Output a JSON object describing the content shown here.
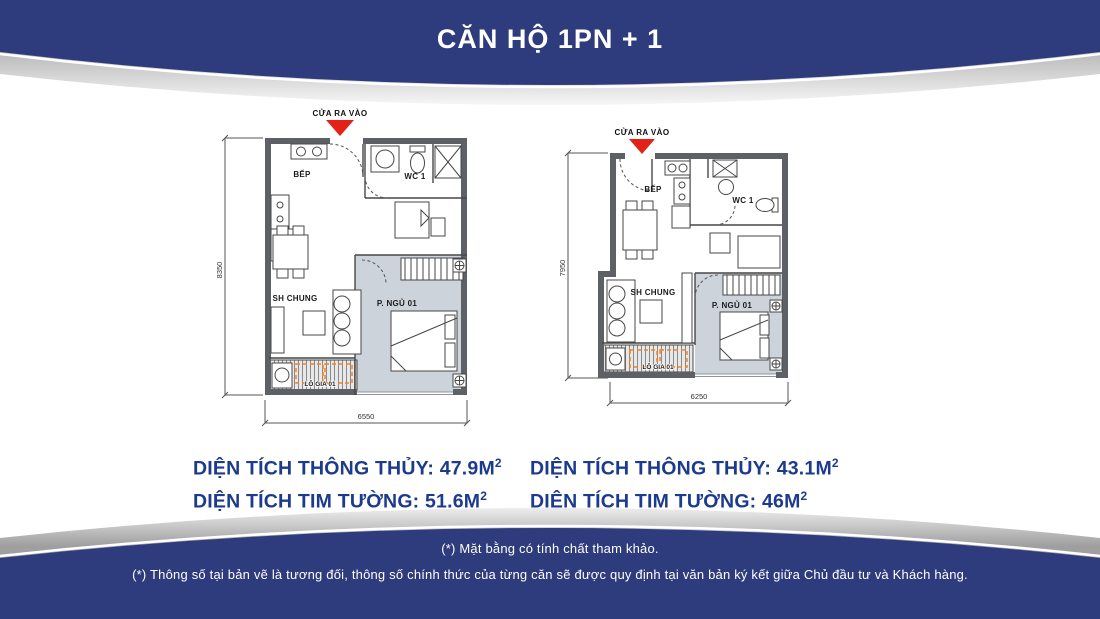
{
  "header": {
    "title": "CĂN HỘ 1PN + 1"
  },
  "plans": [
    {
      "id": "left-plan",
      "entrance_label": "CỬA RA VÀO",
      "rooms": {
        "kitchen": "BẾP",
        "wc": "WC 1",
        "living": "SH CHUNG",
        "bedroom": "P. NGỦ 01",
        "loggia": "LÔ GIA 01"
      },
      "dimensions": {
        "width_mm": "6550",
        "height_mm": "8350"
      },
      "areas": [
        {
          "text": "DIỆN TÍCH THÔNG THỦY: 47.9M",
          "sup": "2"
        },
        {
          "text": "DIỆN TÍCH TIM TƯỜNG: 51.6M",
          "sup": "2"
        }
      ]
    },
    {
      "id": "right-plan",
      "entrance_label": "CỬA RA VÀO",
      "rooms": {
        "kitchen": "BẾP",
        "wc": "WC 1",
        "living": "SH CHUNG",
        "bedroom": "P. NGỦ 01",
        "loggia": "LÔ GIA 01"
      },
      "dimensions": {
        "width_mm": "6250",
        "height_mm": "7950"
      },
      "areas": [
        {
          "text": "DIỆN TÍCH THÔNG THỦY: 43.1M",
          "sup": "2"
        },
        {
          "text": "DIỆN TÍCH TIM TƯỜNG: 46M",
          "sup": "2"
        }
      ]
    }
  ],
  "footer": {
    "line1": "(*) Mặt bằng có tính chất tham khảo.",
    "line2": "(*) Thông số tại bản vẽ là tương đối, thông số chính thức của từng căn sẽ được quy định tại văn bản ký kết giữa Chủ đầu tư và Khách hàng."
  },
  "colors": {
    "band_navy": "#2e3b7c",
    "area_text_blue": "#1c3b8e",
    "entrance_red": "#e32119",
    "bedroom_floor": "#cdd3db",
    "wall_gray": "#5d6166",
    "loggia_accent_orange": "#ef8225"
  }
}
